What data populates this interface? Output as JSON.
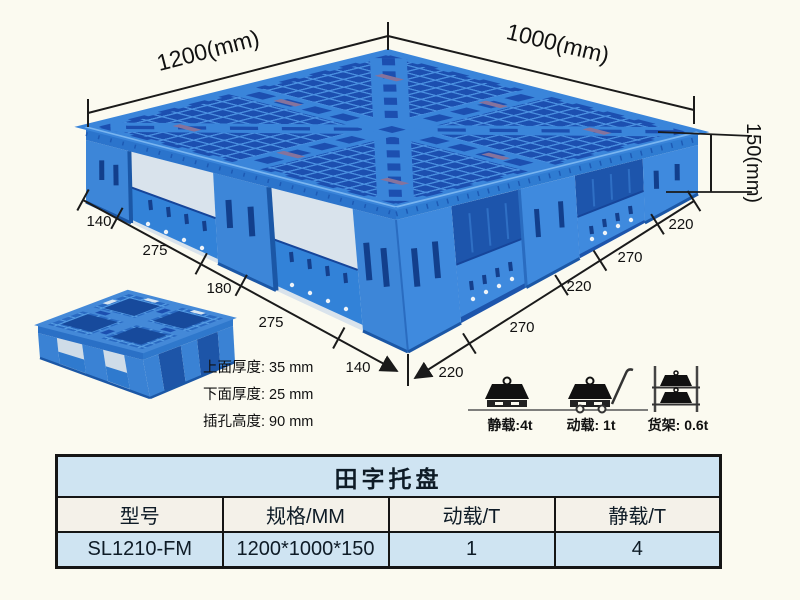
{
  "product": {
    "name": "田字托盘",
    "model": "SL1210-FM"
  },
  "dims": {
    "top_left": "1200(mm)",
    "top_right": "1000(mm)",
    "height": "150(mm)",
    "left_edge": [
      "140",
      "275",
      "180",
      "275",
      "140"
    ],
    "right_edge": [
      "220",
      "270",
      "220",
      "270",
      "220"
    ]
  },
  "notes": {
    "top_thickness": "上面厚度: 35 mm",
    "bottom_thickness": "下面厚度: 25 mm",
    "hole_height": "插孔高度: 90 mm"
  },
  "load": [
    {
      "label": "静载:4t"
    },
    {
      "label": "动载: 1t"
    },
    {
      "label": "货架: 0.6t"
    }
  ],
  "table": {
    "title": "田字托盘",
    "headers": [
      "型号",
      "规格/MM",
      "动载/T",
      "静载/T"
    ],
    "row": [
      "SL1210-FM",
      "1200*1000*150",
      "1",
      "4"
    ]
  },
  "colors": {
    "background": "#fbfaf0",
    "pallet_blue": "#3d86d8",
    "pallet_dark": "#1c4fb0",
    "table_blue": "#cfe4f2",
    "table_cream": "#f4f1e9",
    "line": "#1a1a1a"
  }
}
